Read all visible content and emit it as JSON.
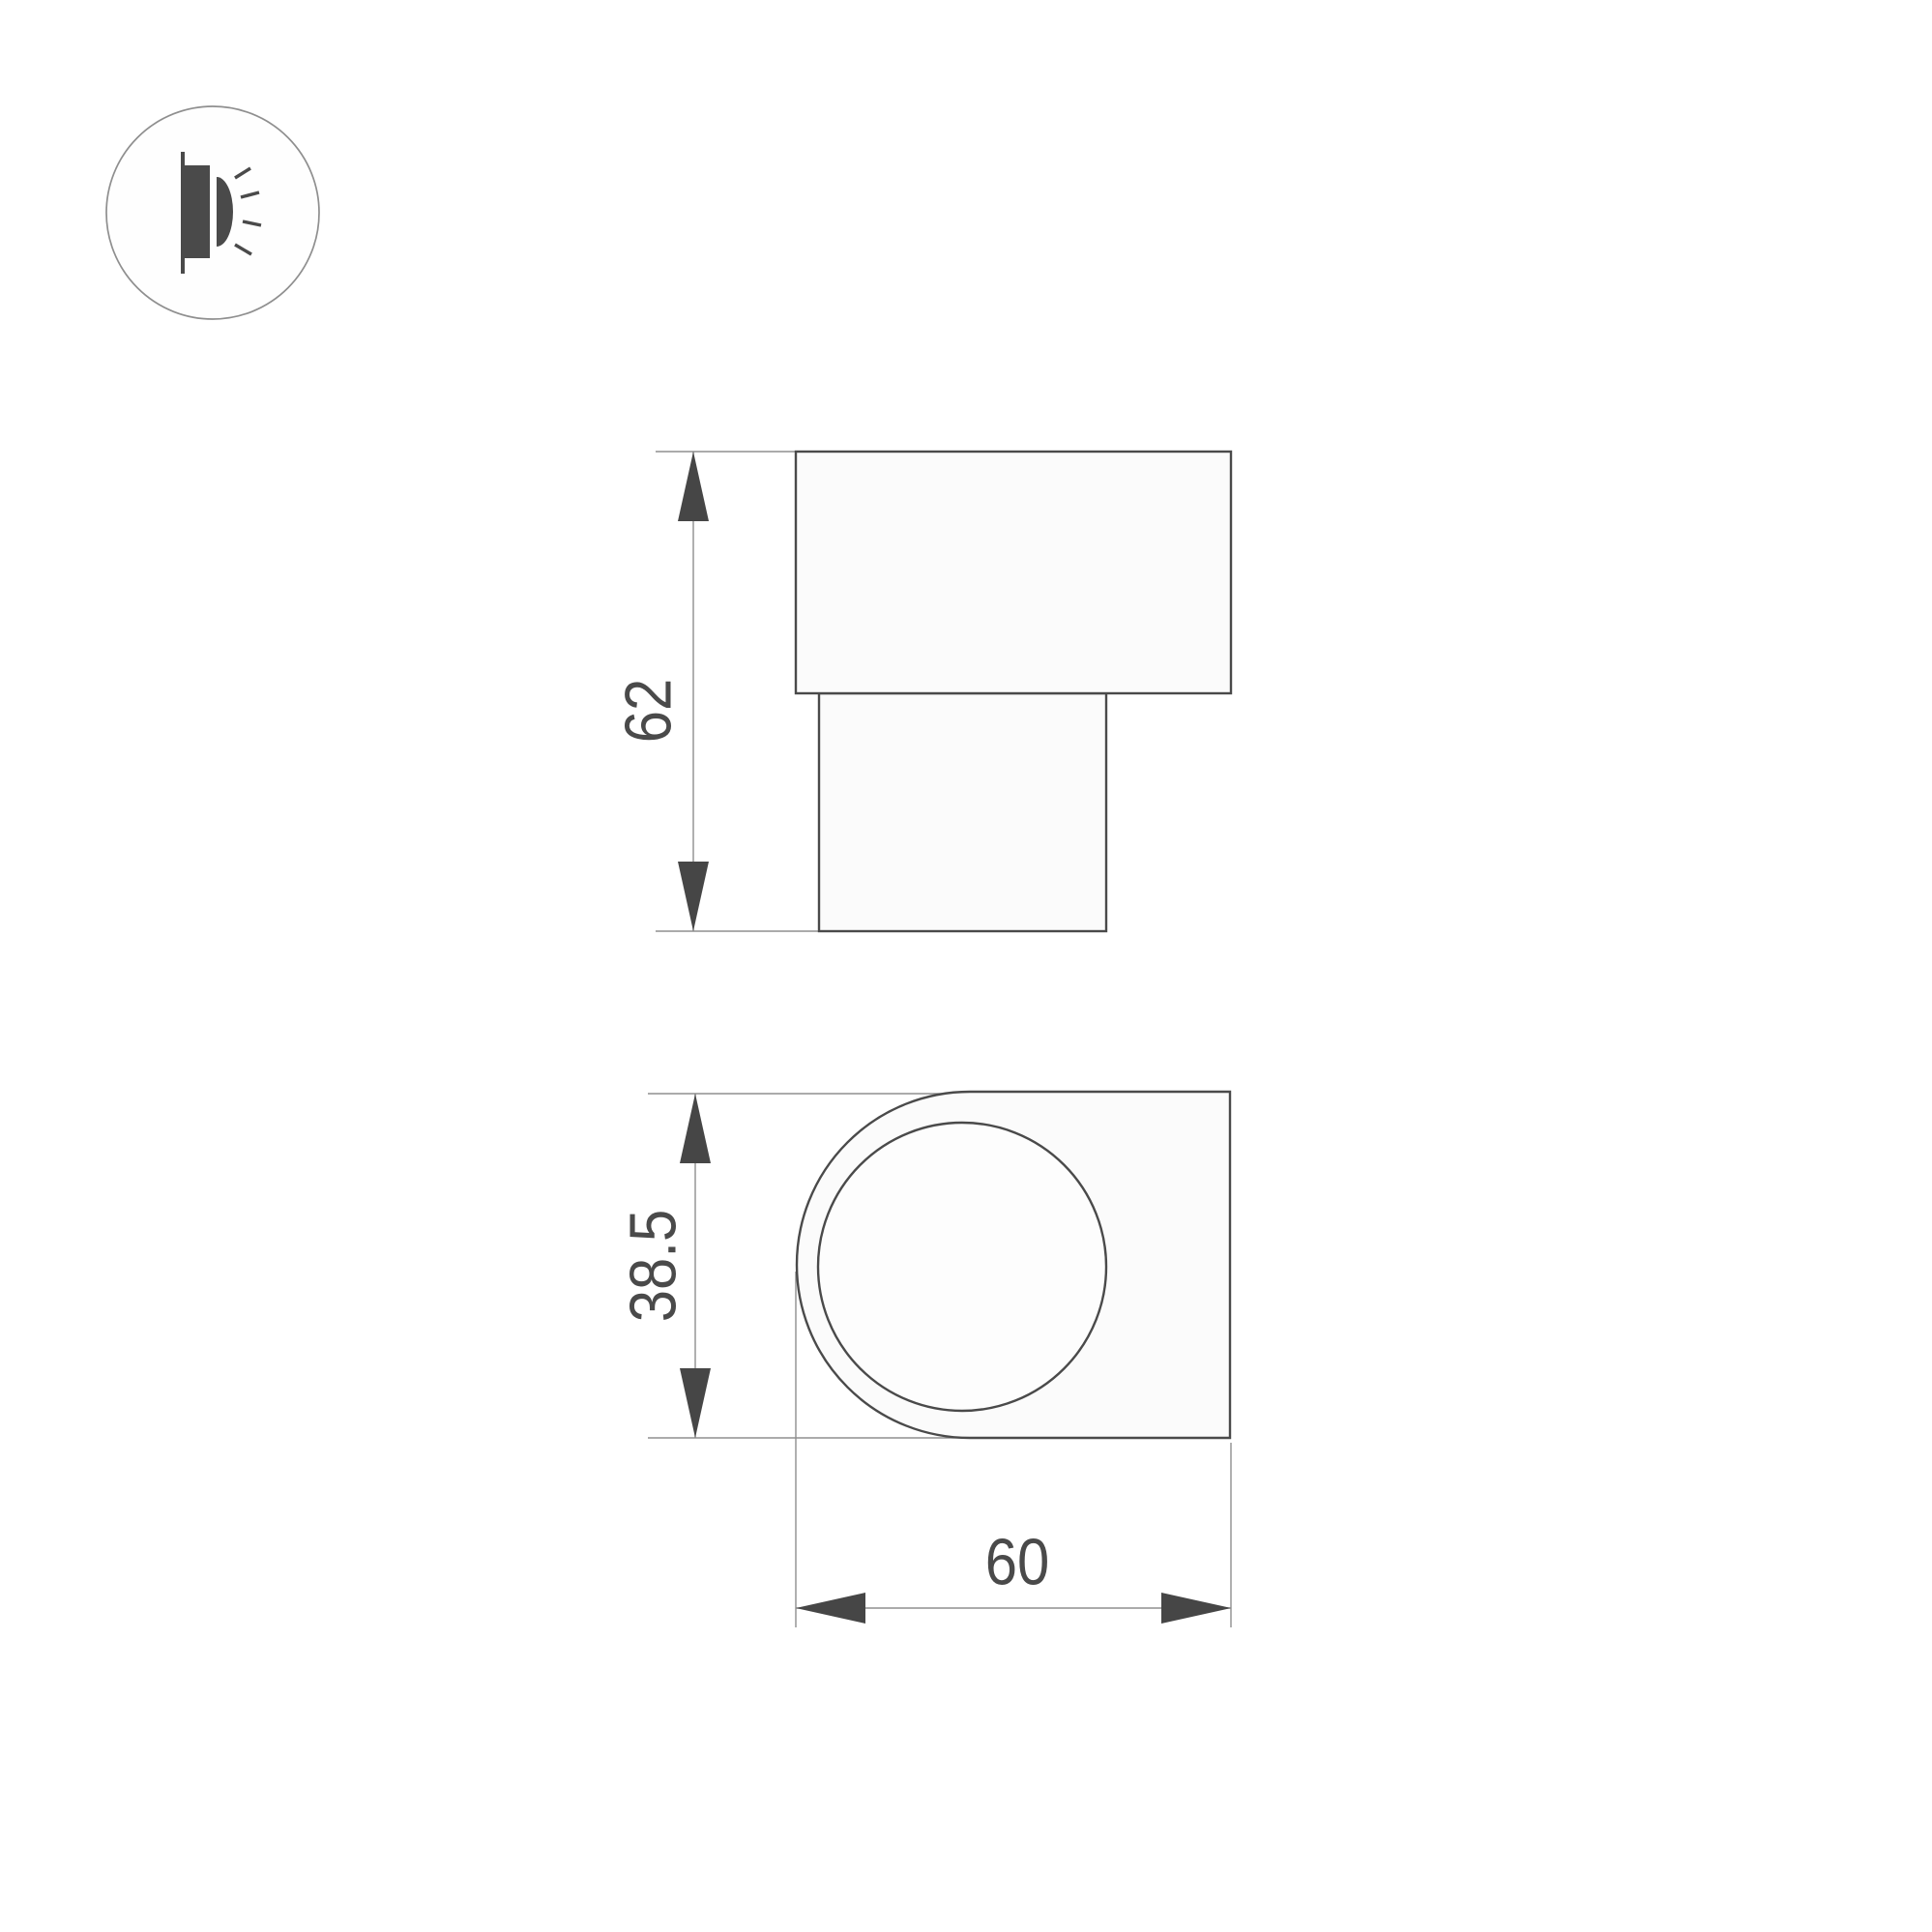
{
  "page": {
    "background_color": "#ffffff"
  },
  "icon": {
    "name": "wall-light-icon",
    "description": "circular badge with wall-mounted luminaire glyph emitting light rays"
  },
  "drawing": {
    "type": "technical-dimension-drawing",
    "colors": {
      "outline": "#4a4a4a",
      "dimension_line": "#8f8f8f",
      "arrow": "#464646",
      "dimension_text": "#4a4a4a"
    },
    "side_view": {
      "height_dim": "62"
    },
    "front_view": {
      "height_dim": "38.5",
      "width_dim": "60"
    }
  }
}
